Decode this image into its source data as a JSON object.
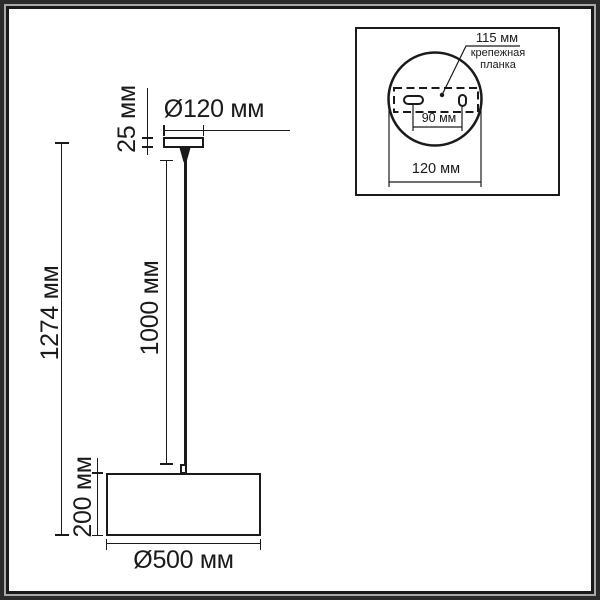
{
  "figure": {
    "kind": "pendant-lamp-dimension-drawing",
    "units": "мм"
  },
  "colors": {
    "ink": "#1a1a1a",
    "paper": "#ffffff",
    "frame_outer": "#2b2b2b",
    "frame_mid": "#a9a9a9"
  },
  "main_view": {
    "dim_canopy_diameter": "Ø120 мм",
    "dim_canopy_height": "25 мм",
    "dim_total_height": "1274 мм",
    "dim_cord_length": "1000 мм",
    "dim_shade_height": "200 мм",
    "dim_shade_diameter": "Ø500 мм"
  },
  "inset_view": {
    "dim_bracket_length": "115 мм",
    "bracket_label_line1": "крепежная",
    "bracket_label_line2": "планка",
    "dim_hole_spacing": "90 мм",
    "dim_canopy_diameter": "120 мм"
  }
}
